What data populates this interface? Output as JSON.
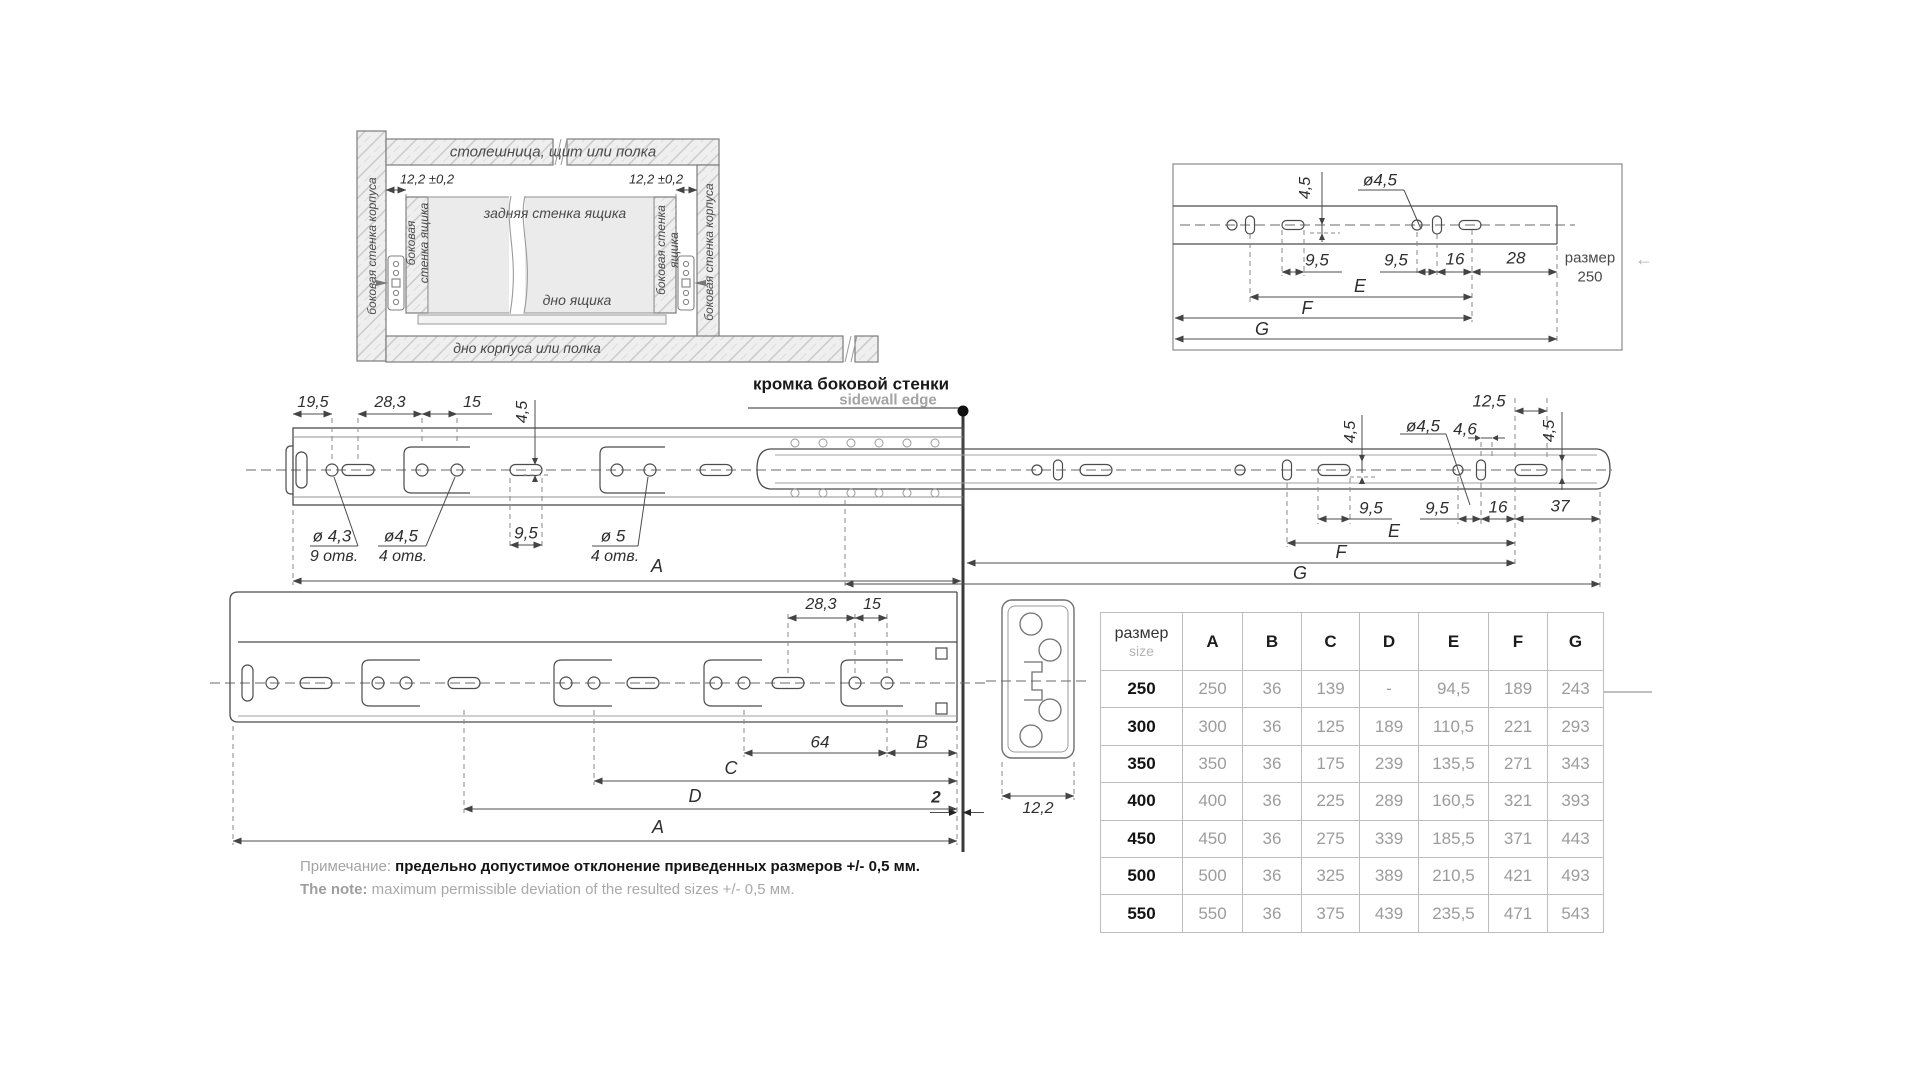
{
  "cabinet": {
    "top_panel": "столешница, щит или полка",
    "offset": "12,2 ±0,2",
    "side_wall": "боковая стенка корпуса",
    "drawer_side_l1": "боковая",
    "drawer_side_l2": "стенка ящика",
    "drawer_side_r1": "боковая стенка",
    "drawer_side_r2": "ящика",
    "drawer_back": "задняя стенка ящика",
    "drawer_bottom": "дно ящика",
    "cabinet_bottom": "дно корпуса или полка"
  },
  "detail": {
    "d45": "4,5",
    "dia45": "ø4,5",
    "d95a": "9,5",
    "d95b": "9,5",
    "d16": "16",
    "d28": "28",
    "size_label": "размер",
    "size_value": "250",
    "E": "E",
    "F": "F",
    "G": "G",
    "arrow": "←"
  },
  "edge": {
    "ru": "кромка боковой стенки",
    "en": "sidewall edge"
  },
  "open": {
    "d195": "19,5",
    "d283": "28,3",
    "d15": "15",
    "d45": "4,5",
    "dia43": "ø 4,3",
    "dia43n": "9 отв.",
    "dia45": "ø4,5",
    "dia45n": "4 отв.",
    "d95": "9,5",
    "dia5": "ø 5",
    "dia5n": "4 отв.",
    "A": "A",
    "rd45l": "4,5",
    "rdia45": "ø4,5",
    "rd125": "12,5",
    "rd46": "4,6",
    "rd45r": "4,5",
    "rd95a": "9,5",
    "rd95b": "9,5",
    "rd16": "16",
    "rd37": "37",
    "E": "E",
    "F": "F",
    "G": "G"
  },
  "closed": {
    "d283": "28,3",
    "d15": "15",
    "d64": "64",
    "B": "B",
    "C": "C",
    "D": "D",
    "A": "A",
    "gap": "2",
    "profile": "12,2"
  },
  "table": {
    "size_ru": "размер",
    "size_en": "size",
    "cols": [
      "A",
      "B",
      "C",
      "D",
      "E",
      "F",
      "G"
    ],
    "rows": [
      {
        "size": "250",
        "a": "250",
        "b": "36",
        "c": "139",
        "d": "-",
        "e": "94,5",
        "f": "189",
        "g": "243"
      },
      {
        "size": "300",
        "a": "300",
        "b": "36",
        "c": "125",
        "d": "189",
        "e": "110,5",
        "f": "221",
        "g": "293"
      },
      {
        "size": "350",
        "a": "350",
        "b": "36",
        "c": "175",
        "d": "239",
        "e": "135,5",
        "f": "271",
        "g": "343"
      },
      {
        "size": "400",
        "a": "400",
        "b": "36",
        "c": "225",
        "d": "289",
        "e": "160,5",
        "f": "321",
        "g": "393"
      },
      {
        "size": "450",
        "a": "450",
        "b": "36",
        "c": "275",
        "d": "339",
        "e": "185,5",
        "f": "371",
        "g": "443"
      },
      {
        "size": "500",
        "a": "500",
        "b": "36",
        "c": "325",
        "d": "389",
        "e": "210,5",
        "f": "421",
        "g": "493"
      },
      {
        "size": "550",
        "a": "550",
        "b": "36",
        "c": "375",
        "d": "439",
        "e": "235,5",
        "f": "471",
        "g": "543"
      }
    ]
  },
  "note": {
    "ru_label": "Примечание:",
    "ru_text": "предельно допустимое отклонение приведенных размеров",
    "ru_tol": "+/- 0,5 мм.",
    "en_label": "The note:",
    "en_text": "maximum permissible deviation of the resulted sizes",
    "en_tol": "+/- 0,5 мм."
  },
  "colors": {
    "line": "#4c4c4c",
    "gray_text": "#a3a3a3",
    "dark_text": "#1a1a1a",
    "panel_fill": "#ebebeb"
  }
}
